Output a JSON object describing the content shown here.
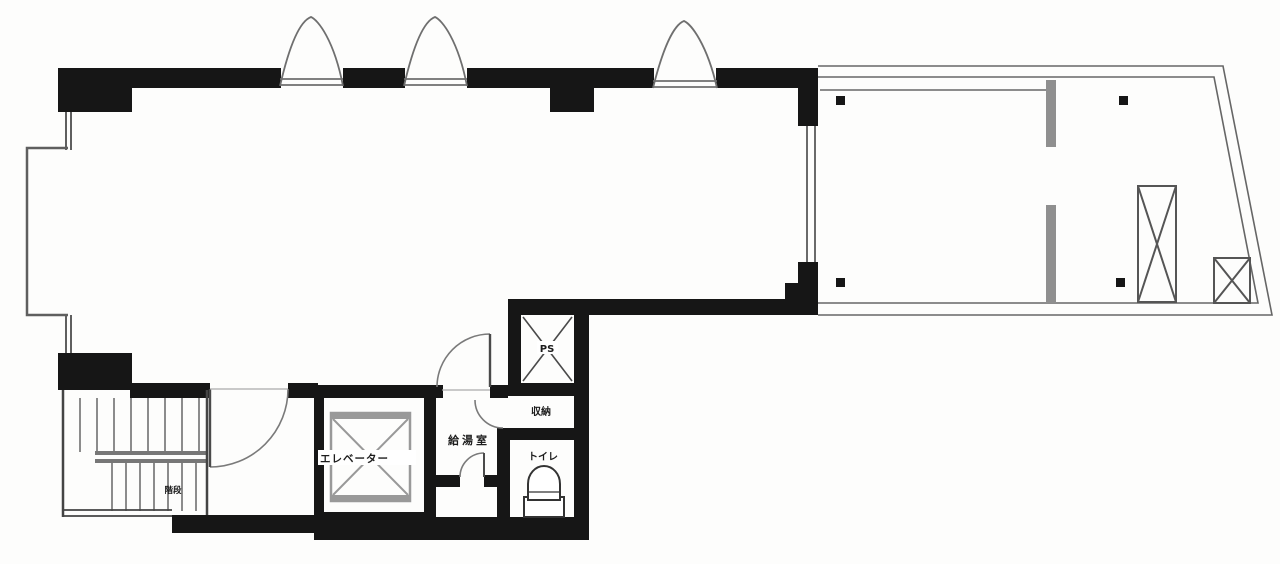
{
  "plan": {
    "kind": "floor-plan",
    "rooms": {
      "ps": "PS",
      "storage": "収納",
      "toilet": "トイレ",
      "kitchenette": "給湯室",
      "elevator": "エレベーター",
      "stairs": "階段"
    },
    "symbols": [
      "window-arch-icon",
      "door-arc-icon",
      "elevator-cab-x-icon",
      "pipe-space-x-icon",
      "evacuation-hatch-x-icon",
      "toilet-bowl-icon",
      "stair-treads-icon",
      "balcony-column-dot-icon"
    ],
    "colors": {
      "wall": "#161616",
      "thin_line": "#5f5f5f",
      "mid_line": "#8f8f8f",
      "background": "#fdfdfc"
    }
  }
}
